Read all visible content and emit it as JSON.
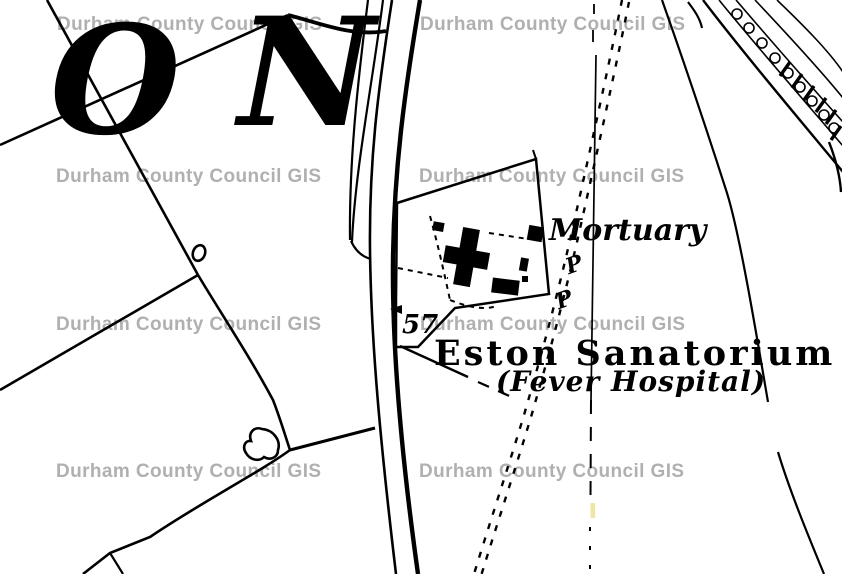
{
  "map": {
    "title_context": "Historic Ordnance Survey style map extract",
    "watermark": {
      "text": "Durham County Council GIS",
      "color": "#b0b0b0"
    },
    "labels": {
      "district_letter_o": "O",
      "district_letter_n": "N",
      "mortuary": "Mortuary",
      "sanatorium": "Eston Sanatorium",
      "sanatorium_subtitle": "(Fever Hospital)",
      "plot_number": "57",
      "boundary_marker_1": "P",
      "boundary_marker_2": "P"
    },
    "colors": {
      "ink": "#000000",
      "background": "#ffffff",
      "watermark": "#b0b0b0",
      "highlight_dash": "#efe6a6"
    }
  }
}
